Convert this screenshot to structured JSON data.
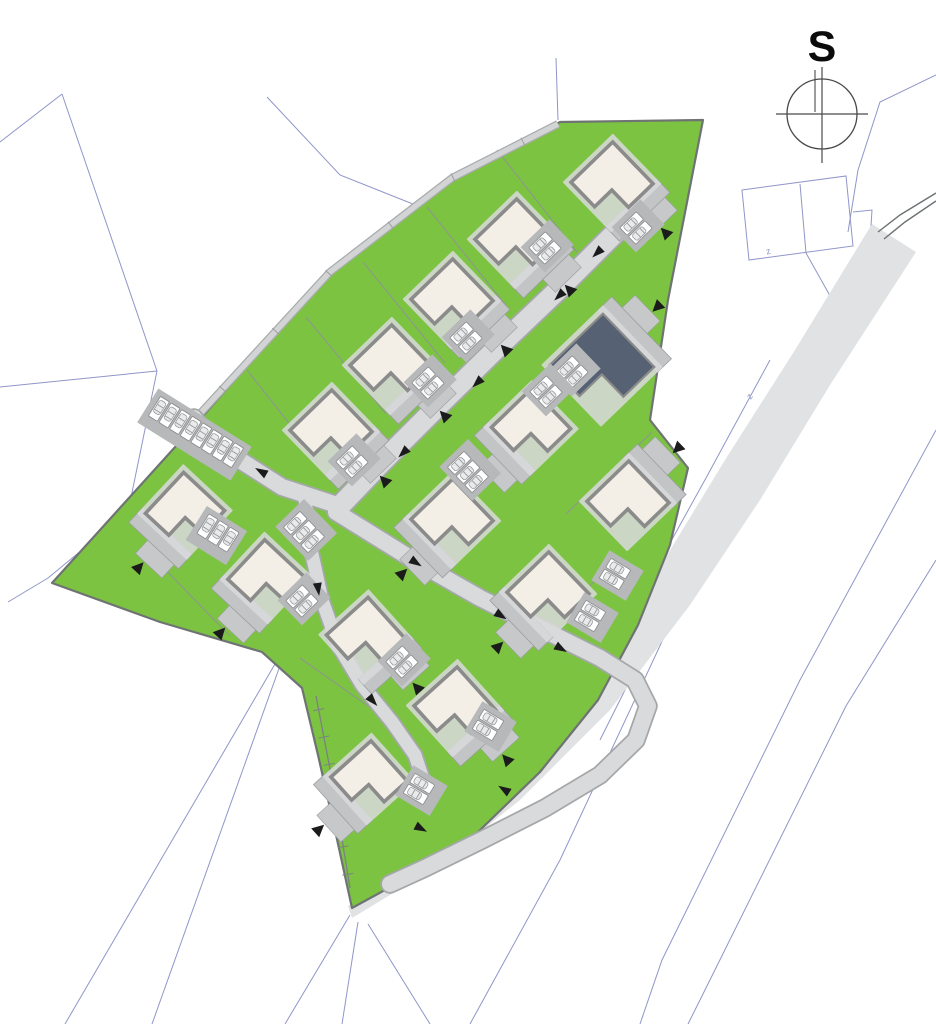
{
  "compass": {
    "label": "S",
    "cx": 822,
    "cy": 114,
    "r": 35
  },
  "colors": {
    "lawn": "#7cc342",
    "lawn_edge": "#6f7374",
    "house_fill": "#f3efe6",
    "house_stroke": "#8b8b8b",
    "dark_fill": "#566173",
    "halo": "#d9dadb",
    "apron": "#c2c4c6",
    "apron_edge": "#9c9ea0",
    "drive": "#c6c8ca",
    "road": "#d8dadb",
    "road_edge": "#a5a7a9",
    "path": "#d2d4d5",
    "path_edge": "#a9abad",
    "existing_road": "#e0e2e3",
    "existing_edge": "#6d7173",
    "park_apron": "#b6b8ba",
    "spot_fill": "#ffffff",
    "spot_stroke": "#8e9092",
    "car_fill": "#e9eaeb",
    "car_stroke": "#96989a",
    "cadastral": "#8f96c8",
    "divider": "#8f9496",
    "wall": "#7d8184",
    "arrow": "#1b1b1b",
    "compass_stroke": "#4a4a4a"
  },
  "site": {
    "outline": [
      [
        52,
        583
      ],
      [
        195,
        425
      ],
      [
        330,
        272
      ],
      [
        452,
        178
      ],
      [
        560,
        122
      ],
      [
        703,
        120
      ],
      [
        668,
        300
      ],
      [
        650,
        420
      ],
      [
        688,
        468
      ],
      [
        670,
        545
      ],
      [
        638,
        625
      ],
      [
        598,
        700
      ],
      [
        540,
        772
      ],
      [
        478,
        832
      ],
      [
        418,
        872
      ],
      [
        352,
        908
      ],
      [
        335,
        830
      ],
      [
        318,
        755
      ],
      [
        302,
        688
      ],
      [
        262,
        652
      ],
      [
        160,
        622
      ]
    ]
  },
  "existing_road": {
    "outline": [
      [
        872,
        224
      ],
      [
        795,
        350
      ],
      [
        725,
        460
      ],
      [
        655,
        575
      ],
      [
        585,
        690
      ],
      [
        505,
        785
      ],
      [
        425,
        855
      ],
      [
        348,
        906
      ],
      [
        352,
        918
      ],
      [
        435,
        868
      ],
      [
        520,
        800
      ],
      [
        610,
        710
      ],
      [
        690,
        605
      ],
      [
        760,
        500
      ],
      [
        830,
        385
      ],
      [
        916,
        252
      ]
    ],
    "edge_curves": [
      [
        [
          936,
          193
        ],
        [
          900,
          215
        ],
        [
          878,
          232
        ]
      ],
      [
        [
          936,
          201
        ],
        [
          905,
          222
        ],
        [
          884,
          239
        ]
      ]
    ]
  },
  "cadastral": {
    "lines": [
      [
        [
          62,
          94
        ],
        [
          0,
          142
        ]
      ],
      [
        [
          62,
          94
        ],
        [
          157,
          371
        ]
      ],
      [
        [
          0,
          387
        ],
        [
          157,
          371
        ]
      ],
      [
        [
          157,
          371
        ],
        [
          128,
          512
        ],
        [
          48,
          578
        ]
      ],
      [
        [
          48,
          578
        ],
        [
          8,
          602
        ]
      ],
      [
        [
          267,
          97
        ],
        [
          340,
          175
        ],
        [
          428,
          210
        ]
      ],
      [
        [
          556,
          58
        ],
        [
          558,
          120
        ]
      ],
      [
        [
          296,
          628
        ],
        [
          65,
          1024
        ]
      ],
      [
        [
          282,
          660
        ],
        [
          152,
          1024
        ]
      ],
      [
        [
          350,
          915
        ],
        [
          285,
          1024
        ]
      ],
      [
        [
          358,
          922
        ],
        [
          342,
          1024
        ]
      ],
      [
        [
          368,
          924
        ],
        [
          430,
          1024
        ]
      ],
      [
        [
          838,
          310
        ],
        [
          700,
          560
        ],
        [
          560,
          860
        ],
        [
          470,
          1024
        ]
      ],
      [
        [
          852,
          262
        ],
        [
          745,
          470
        ],
        [
          640,
          660
        ],
        [
          600,
          740
        ]
      ],
      [
        [
          936,
          430
        ],
        [
          800,
          680
        ],
        [
          662,
          960
        ],
        [
          640,
          1024
        ]
      ],
      [
        [
          936,
          560
        ],
        [
          846,
          706
        ],
        [
          700,
          1000
        ],
        [
          688,
          1024
        ]
      ],
      [
        [
          936,
          75
        ],
        [
          880,
          102
        ],
        [
          858,
          170
        ],
        [
          848,
          232
        ]
      ],
      [
        [
          806,
          253
        ],
        [
          838,
          310
        ]
      ],
      [
        [
          770,
          360
        ],
        [
          706,
          478
        ],
        [
          644,
          590
        ],
        [
          604,
          680
        ]
      ],
      [
        [
          853,
          212
        ],
        [
          872,
          210
        ],
        [
          870,
          242
        ]
      ],
      [
        [
          800,
          184
        ],
        [
          806,
          253
        ]
      ]
    ],
    "parcels": [
      [
        [
          742,
          190
        ],
        [
          846,
          176
        ],
        [
          853,
          246
        ],
        [
          749,
          260
        ]
      ]
    ],
    "labels": [
      {
        "t": "z",
        "x": 769,
        "y": 254,
        "r": -15
      },
      {
        "t": "z",
        "x": 752,
        "y": 398,
        "r": -55
      }
    ]
  },
  "nw_path": {
    "pts": [
      [
        196,
        418
      ],
      [
        330,
        272
      ],
      [
        452,
        178
      ],
      [
        558,
        124
      ]
    ],
    "ticks": 6
  },
  "wall": {
    "pts": [
      [
        316,
        696
      ],
      [
        334,
        790
      ],
      [
        350,
        888
      ]
    ],
    "ticks": 7
  },
  "dividers": [
    [
      [
        497,
        150
      ],
      [
        577,
        252
      ]
    ],
    [
      [
        427,
        207
      ],
      [
        508,
        308
      ]
    ],
    [
      [
        363,
        262
      ],
      [
        445,
        363
      ]
    ],
    [
      [
        306,
        317
      ],
      [
        386,
        414
      ]
    ],
    [
      [
        247,
        370
      ],
      [
        322,
        465
      ]
    ],
    [
      [
        652,
        432
      ],
      [
        566,
        514
      ]
    ],
    [
      [
        620,
        558
      ],
      [
        528,
        642
      ]
    ],
    [
      [
        300,
        658
      ],
      [
        385,
        718
      ]
    ],
    [
      [
        152,
        556
      ],
      [
        230,
        636
      ]
    ]
  ],
  "roads": [
    {
      "pts": [
        [
          618,
          230
        ],
        [
          560,
          288
        ],
        [
          495,
          350
        ],
        [
          430,
          414
        ],
        [
          382,
          462
        ],
        [
          340,
          506
        ]
      ],
      "w": 20
    },
    {
      "pts": [
        [
          340,
          506
        ],
        [
          282,
          487
        ],
        [
          232,
          455
        ],
        [
          203,
          430
        ],
        [
          194,
          418
        ]
      ],
      "w": 16
    },
    {
      "pts": [
        [
          336,
          512
        ],
        [
          410,
          558
        ],
        [
          480,
          598
        ],
        [
          548,
          632
        ],
        [
          600,
          658
        ],
        [
          635,
          680
        ],
        [
          648,
          706
        ],
        [
          636,
          740
        ],
        [
          600,
          775
        ],
        [
          545,
          808
        ],
        [
          482,
          840
        ],
        [
          425,
          868
        ],
        [
          390,
          884
        ]
      ],
      "w": 16
    },
    {
      "pts": [
        [
          305,
          498
        ],
        [
          310,
          545
        ],
        [
          322,
          600
        ],
        [
          338,
          645
        ],
        [
          362,
          685
        ],
        [
          392,
          722
        ],
        [
          415,
          755
        ],
        [
          425,
          785
        ]
      ],
      "w": 13
    }
  ],
  "houses": [
    {
      "x": 612,
      "y": 183,
      "s": 58,
      "rot": -44,
      "side": 0,
      "dark": false
    },
    {
      "x": 516,
      "y": 240,
      "s": 58,
      "rot": -44,
      "side": 0,
      "dark": false
    },
    {
      "x": 452,
      "y": 300,
      "s": 58,
      "rot": -44,
      "side": 0,
      "dark": false
    },
    {
      "x": 391,
      "y": 366,
      "s": 58,
      "rot": -44,
      "side": 0,
      "dark": false
    },
    {
      "x": 331,
      "y": 431,
      "s": 58,
      "rot": -44,
      "side": 0,
      "dark": false
    },
    {
      "x": 602,
      "y": 366,
      "s": 74,
      "rot": -44,
      "side": 3,
      "dark": true
    },
    {
      "x": 531,
      "y": 428,
      "s": 56,
      "rot": -44,
      "side": 1,
      "dark": false
    },
    {
      "x": 628,
      "y": 502,
      "s": 58,
      "rot": -44,
      "side": 3,
      "dark": false
    },
    {
      "x": 548,
      "y": 593,
      "s": 58,
      "rot": -44,
      "side": 1,
      "dark": false
    },
    {
      "x": 452,
      "y": 520,
      "s": 58,
      "rot": -44,
      "side": 1,
      "dark": false
    },
    {
      "x": 185,
      "y": 512,
      "s": 56,
      "rot": -47,
      "side": 1,
      "dark": false
    },
    {
      "x": 266,
      "y": 578,
      "s": 54,
      "rot": -47,
      "side": 1,
      "dark": false
    },
    {
      "x": 366,
      "y": 637,
      "s": 56,
      "rot": -42,
      "side": 0,
      "dark": false
    },
    {
      "x": 455,
      "y": 708,
      "s": 58,
      "rot": -42,
      "side": 0,
      "dark": false
    },
    {
      "x": 369,
      "y": 779,
      "s": 54,
      "rot": -42,
      "side": 1,
      "dark": false
    }
  ],
  "parking": [
    {
      "x": 636,
      "y": 228,
      "rot": -44,
      "n": 2,
      "type": "pair"
    },
    {
      "x": 545,
      "y": 248,
      "rot": -44,
      "n": 2,
      "type": "pair"
    },
    {
      "x": 466,
      "y": 338,
      "rot": -44,
      "n": 2,
      "type": "pair"
    },
    {
      "x": 428,
      "y": 383,
      "rot": -44,
      "n": 2,
      "type": "pair"
    },
    {
      "x": 352,
      "y": 462,
      "rot": -44,
      "n": 2,
      "type": "pair"
    },
    {
      "x": 196,
      "y": 432,
      "rot": 32,
      "n": 8,
      "type": "row"
    },
    {
      "x": 218,
      "y": 533,
      "rot": 32,
      "n": 3,
      "type": "row"
    },
    {
      "x": 304,
      "y": 532,
      "rot": -44,
      "n": 3,
      "type": "pair"
    },
    {
      "x": 302,
      "y": 601,
      "rot": -44,
      "n": 2,
      "type": "pair"
    },
    {
      "x": 402,
      "y": 662,
      "rot": -44,
      "n": 2,
      "type": "pair"
    },
    {
      "x": 572,
      "y": 372,
      "rot": -44,
      "n": 2,
      "type": "pair"
    },
    {
      "x": 546,
      "y": 392,
      "rot": -44,
      "n": 2,
      "type": "pair"
    },
    {
      "x": 468,
      "y": 472,
      "rot": -44,
      "n": 3,
      "type": "pair"
    },
    {
      "x": 615,
      "y": 574,
      "rot": 31,
      "n": 2,
      "type": "pair"
    },
    {
      "x": 590,
      "y": 616,
      "rot": 31,
      "n": 2,
      "type": "pair"
    },
    {
      "x": 419,
      "y": 789,
      "rot": 31,
      "n": 2,
      "type": "pair"
    },
    {
      "x": 488,
      "y": 725,
      "rot": 31,
      "n": 2,
      "type": "pair"
    }
  ],
  "road_arrows": [
    [
      560,
      295,
      136
    ],
    [
      478,
      382,
      136
    ],
    [
      404,
      452,
      136
    ],
    [
      598,
      252,
      136
    ],
    [
      262,
      472,
      210
    ],
    [
      415,
      562,
      33
    ],
    [
      500,
      615,
      33
    ],
    [
      560,
      648,
      30
    ],
    [
      318,
      588,
      82
    ],
    [
      372,
      700,
      48
    ],
    [
      420,
      828,
      28
    ],
    [
      505,
      790,
      212
    ]
  ]
}
